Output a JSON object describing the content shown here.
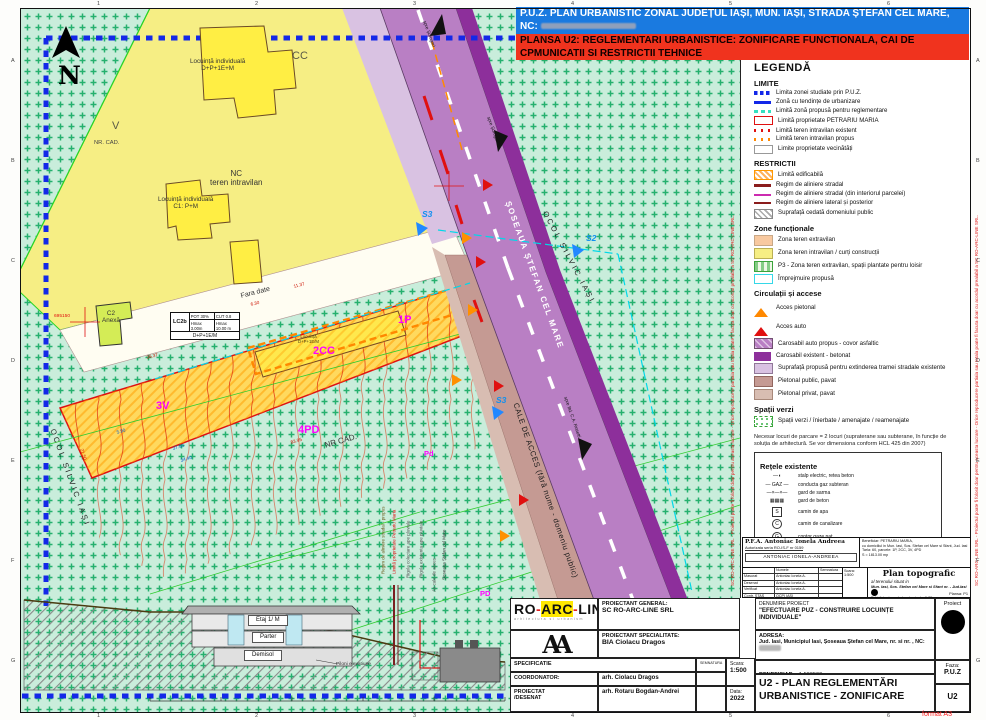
{
  "title_bar": {
    "line1": "P.U.Z. PLAN URBANISTIC ZONAL  JUDEȚUL IAȘI, MUN. IAȘI,  STRADA ȘTEFAN CEL MARE, NC:",
    "line2": "PLANSA U2: REGLEMENTARI URBANISTICE: ZONIFICARE FUNCTIONALA, CAI DE CPMUNICATII SI RESTRICTII TEHNICE"
  },
  "legend": {
    "title": "LEGENDĂ",
    "sections": [
      {
        "title": "LIMITE",
        "items": [
          {
            "sw": "blueDash",
            "label": "Limita zonei studiate prin P.U.Z."
          },
          {
            "sw": "blueSolid",
            "label": "Zonă cu tendințe de urbanizare"
          },
          {
            "sw": "cyanDash",
            "label": "Limită zonă propusă pentru reglementare"
          },
          {
            "sw": "redRect",
            "label": "Limită proprietate PETRARIU MARIA"
          },
          {
            "sw": "redDots",
            "label": "Limită teren intravilan existent"
          },
          {
            "sw": "orangeDots",
            "label": "Limită teren intravilan propus"
          },
          {
            "sw": "grayRect",
            "label": "Limite proprietate vecinătăți"
          }
        ]
      },
      {
        "title": "RESTRICTII",
        "items": [
          {
            "sw": "orangeHatch",
            "label": "Limită edificabilă"
          },
          {
            "sw": "darkredThick",
            "label": "Regim de aliniere stradal"
          },
          {
            "sw": "magentaLine",
            "label": "Regim de aliniere stradal (din interiorul parcelei)"
          },
          {
            "sw": "darkredThin",
            "label": "Regim de aliniere lateral și posterior"
          },
          {
            "sw": "grayHatch",
            "label": "Suprafață cedată domeniului public"
          }
        ]
      },
      {
        "title": "Zone funcționale",
        "items": [
          {
            "sw": "peach",
            "label": "Zona teren extravilan"
          },
          {
            "sw": "yellow",
            "label": "Zona teren intravilan / curți construcții"
          },
          {
            "sw": "greenHatch",
            "label": "P3 - Zona teren extravilan, spații plantate pentru loisir"
          },
          {
            "sw": "cyanRect",
            "label": "Împrejmuire propusă"
          }
        ]
      },
      {
        "title": "Circulații și accese",
        "items": [
          {
            "sw": "triO",
            "label": "Acces pietonal"
          },
          {
            "sw": "triR",
            "label": "Acces auto"
          },
          {
            "sw": "purpleHatch",
            "label": "Carosabil auto propus - covor asfaltic"
          },
          {
            "sw": "darkPurple",
            "label": "Carosabil existent - betonat"
          },
          {
            "sw": "lightPurple",
            "label": "Suprafață propusă pentru extinderea tramei stradale existente"
          },
          {
            "sw": "brown",
            "label": "Pietonal public, pavat"
          },
          {
            "sw": "lightBrown",
            "label": "Pietonal privat, pavat"
          }
        ]
      },
      {
        "title": "Spații verzi",
        "items": [
          {
            "sw": "greenDots",
            "label": "Spații verzi / înierbate / amenajate / reamenajate"
          }
        ]
      }
    ],
    "note": "Necesar locuri de parcare = 2 locuri (supraterane sau subterane, în funcție de soluția de arhitectură. Se vor dimensiona conform HCL 425 din 2007)",
    "networks": {
      "title": "Rețele existente",
      "items": [
        {
          "sym": "lamp",
          "label": "stalp electric, retea beton"
        },
        {
          "sym": "gaz",
          "label": "conducta gaz subteran"
        },
        {
          "sym": "sarma",
          "label": "gard de sarma"
        },
        {
          "sym": "beton",
          "label": "gard de beton"
        },
        {
          "sym": "sq",
          "ch": "S",
          "label": "camin de apa"
        },
        {
          "sym": "ci",
          "ch": "C",
          "label": "camin de canalizare"
        },
        {
          "sym": "ci",
          "ch": "G",
          "label": "contor gaze nat"
        }
      ]
    }
  },
  "map": {
    "lc2b": {
      "code": "LC2b",
      "pot": "POT 30%",
      "cut": "CUT 0.8",
      "h1": "Hmax 3.00m",
      "h2": "Hmax 10.00 m",
      "regim": "D+P+1E/M"
    },
    "labels": [
      {
        "t": "N",
        "x": 58,
        "y": 62,
        "cls": "north"
      },
      {
        "t": "CC",
        "x": 292,
        "y": 50,
        "cls": "parcel"
      },
      {
        "t": "Locuință individuală\nD+P+1E+M",
        "x": 190,
        "y": 58,
        "cls": "bld"
      },
      {
        "t": "V",
        "x": 112,
        "y": 120,
        "cls": "parcel"
      },
      {
        "t": "NR. CAD.",
        "x": 94,
        "y": 140,
        "cls": "small"
      },
      {
        "t": "NC\nteren intravilan",
        "x": 210,
        "y": 170,
        "cls": "med"
      },
      {
        "t": "Locuință individuală\nC1: P+M",
        "x": 158,
        "y": 196,
        "cls": "bld"
      },
      {
        "t": "C2\nAnexă",
        "x": 102,
        "y": 310,
        "cls": "bld"
      },
      {
        "t": "695150",
        "x": 54,
        "y": 314,
        "cls": "coord"
      },
      {
        "t": "OCOL SILVIC IAȘI",
        "x": 56,
        "y": 428,
        "r": 70,
        "cls": "forest"
      },
      {
        "t": "Fara date",
        "x": 240,
        "y": 293,
        "r": -14,
        "cls": "roadname"
      },
      {
        "t": "11.37",
        "x": 293,
        "y": 284,
        "r": -14,
        "cls": "dim"
      },
      {
        "t": "6.30",
        "x": 250,
        "y": 302,
        "r": -14,
        "cls": "dim"
      },
      {
        "t": "36.37",
        "x": 146,
        "y": 355,
        "r": -14,
        "cls": "dim"
      },
      {
        "t": "83.95",
        "x": 290,
        "y": 440,
        "r": -16,
        "cls": "dim"
      },
      {
        "t": "NR CAD.",
        "x": 324,
        "y": 442,
        "r": -16,
        "cls": "med"
      },
      {
        "t": "1P",
        "x": 398,
        "y": 314,
        "cls": "zone"
      },
      {
        "t": "Locuință\nD+P+1E/M",
        "x": 298,
        "y": 335,
        "cls": "tinybld"
      },
      {
        "t": "2CC",
        "x": 313,
        "y": 345,
        "cls": "zone"
      },
      {
        "t": "3V",
        "x": 156,
        "y": 400,
        "cls": "zone"
      },
      {
        "t": "4PD",
        "x": 298,
        "y": 424,
        "cls": "zone"
      },
      {
        "t": "Pd",
        "x": 424,
        "y": 450,
        "cls": "zonesm"
      },
      {
        "t": "PD",
        "x": 480,
        "y": 590,
        "cls": "zonesm"
      },
      {
        "t": "ȘOSEAUA ȘTEFAN CEL MARE",
        "x": 512,
        "y": 200,
        "r": 70,
        "cls": "roadwhite"
      },
      {
        "t": "OCOL SILVIC IAȘI",
        "x": 548,
        "y": 210,
        "r": 62,
        "cls": "forest"
      },
      {
        "t": "S2",
        "x": 586,
        "y": 234,
        "cls": "slabel"
      },
      {
        "t": "S3",
        "x": 422,
        "y": 210,
        "cls": "slabel"
      },
      {
        "t": "S3",
        "x": 496,
        "y": 396,
        "cls": "slabel"
      },
      {
        "t": "CALE DE ACCES (fără nume - domeniu public)",
        "x": 519,
        "y": 402,
        "r": 71,
        "cls": "roaddark"
      },
      {
        "t": "spre Șorogari",
        "x": 427,
        "y": 20,
        "r": 70,
        "cls": "dir"
      },
      {
        "t": "spre Șorogari",
        "x": 491,
        "y": 116,
        "r": 70,
        "cls": "dir"
      },
      {
        "t": "spre Bd. C.A. Rosetti",
        "x": 568,
        "y": 396,
        "r": 71,
        "cls": "dir"
      },
      {
        "t": "37.50",
        "x": 172,
        "y": 446,
        "r": -16,
        "cls": "dimb"
      },
      {
        "t": "34.40",
        "x": 180,
        "y": 458,
        "r": -16,
        "cls": "dimb"
      },
      {
        "t": "5.90",
        "x": 116,
        "y": 430,
        "r": -16,
        "cls": "dimb"
      },
      {
        "t": "21.50",
        "x": 84,
        "y": 448,
        "r": 72,
        "cls": "dim"
      },
      {
        "t": "Etaj 1/ M",
        "x": 248,
        "y": 615,
        "cls": "floor"
      },
      {
        "t": "Parter",
        "x": 252,
        "y": 632,
        "cls": "floor"
      },
      {
        "t": "Demisol",
        "x": 244,
        "y": 650,
        "cls": "floor"
      },
      {
        "t": "Piloni elevatiune",
        "x": 336,
        "y": 662,
        "cls": "secnote"
      },
      {
        "t": "Regim de aliniere stradal - propus",
        "x": 386,
        "y": 574,
        "cls": "vrt",
        "c": "#6b5a1a"
      },
      {
        "t": "Limită proprietate Petrariu Maria",
        "x": 397,
        "y": 574,
        "cls": "vrt",
        "c": "#e01010"
      },
      {
        "t": "Rigola colectare ape pluviale",
        "x": 411,
        "y": 578,
        "cls": "vrt",
        "c": "#555555"
      },
      {
        "t": "Rigola existenta ape pluviale",
        "x": 424,
        "y": 578,
        "cls": "vrt",
        "c": "#555555"
      },
      {
        "t": "Ax cale de acces",
        "x": 437,
        "y": 592,
        "cls": "vrt",
        "c": "#555555"
      },
      {
        "t": "Șoseaua Ștefan cel Mare",
        "x": 447,
        "y": 580,
        "cls": "vrt",
        "c": "#333333"
      }
    ]
  },
  "plan_block": {
    "firm": "P.F.A.  Antoniac Ionela Andreea",
    "auth": "Autorizata seria RO-IS-F nr 0159",
    "stamp": "ANTONIAC IONELA-ANDREEA",
    "col_name": "Numele",
    "col_sign": "Semnatura",
    "rows": [
      [
        "Masurat",
        "Antoniac Ionela A."
      ],
      [
        "Desenat",
        "Antoniac Ionela A."
      ],
      [
        "Verificat",
        "Antoniac Ionela A."
      ],
      [
        "Contr. STAS",
        "OCPI IASI"
      ]
    ],
    "scale_label": "Scara:",
    "scale": "1:500",
    "title": "Plan topografic",
    "subtitle": "al terenului situat in",
    "location": "Mun. Iasi, Sos. Stefan cel Mare si Sfant nr.  - Jud.Iasi",
    "details": [
      "Echidistanta curbelor de nivel = 0.25 m.",
      "Sistem de proiectie Stereo 1970",
      "Plan de referinta Marea Neagra"
    ],
    "beneficiar_lines": [
      "Beneficiar: PETRARIU MARIA,",
      "cu domiciliul in Mun. Iasi, Sos. Stefan cel Mare si Sfant, Jud. Iasi",
      "Tarla: 60, parcele: 1P, 2CC, 3V, 4PD",
      "S = 1813.00 mp"
    ],
    "plansa_label": "Plansa:",
    "plansa": "P1"
  },
  "title_block": {
    "logo_part1": "RO",
    "logo_part2": "ARC",
    "logo_part3": "LINE",
    "logo_sub": "arhitectura si urbanism",
    "monogram": "AA",
    "pg_label": "PROIECTANT GENERAL:",
    "pg": "SC RO-ARC-LINE SRL",
    "ps_label": "PROIECTANT SPECIALITATE:",
    "ps": "BIA Ciolacu Dragos",
    "spec": "SPECIFICATIE",
    "sem": "SEMNATURA",
    "coord_label": "COORDONATOR:",
    "coord": "arh. Ciolacu Dragos",
    "proi_label": "PROIECTAT\n/DESENAT",
    "proi": "arh. Rotaru Bogdan-Andrei",
    "scara_label": "Scara:",
    "scara": "1:500",
    "data_label": "Data:",
    "data": "2022",
    "den_label": "DENUMIRE PROIECT",
    "den": "\"EFECTUARE PUZ - CONSTRUIRE LOCUINȚE INDIVIDUALE\"",
    "adresa_label": "ADRESA:",
    "adresa": "Jud. Iasi, Municipiul Iasi, Șoseaua Ștefan cel Mare, nr.   si nr.  ,  NC:",
    "ben_label": "BENEFICIAR:",
    "ben": "1:500500.",
    "proiect_label": "Proiect",
    "faza_label": "Faza:",
    "faza": "P.U.Z",
    "plansa_code": "U2",
    "sheet_title1": "U2 - PLAN REGLEMENTĂRI",
    "sheet_title2": "URBANISTICE - ZONIFICARE"
  },
  "sheet": {
    "format_note": "format A3",
    "frame_numbers": [
      "1",
      "2",
      "3",
      "4",
      "5",
      "6"
    ],
    "frame_letters": [
      "A",
      "B",
      "C",
      "D",
      "E",
      "F",
      "G"
    ],
    "side_note": "SC RO-ARC-LINE SRL - Proiectul poate fi folosit doar pentru aceasta lucrare - Orice reproducere partiala sau totala poate fi facuta doar cu acordul prealabil a SC RO-ARC-LINE SRL."
  }
}
